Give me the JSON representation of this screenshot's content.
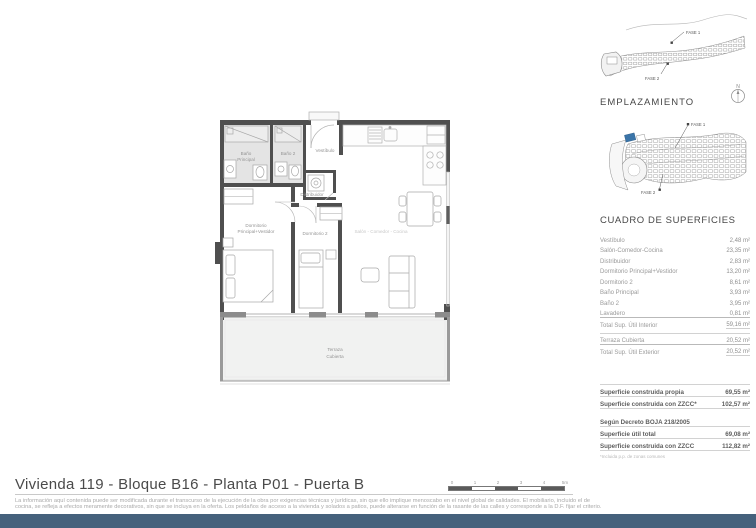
{
  "floorplan": {
    "labels": {
      "bano_principal_1": "Baño",
      "bano_principal_2": "Principal",
      "bano2": "Baño 2",
      "vestibulo": "Vestíbulo",
      "distribuidor": "Distribuidor",
      "dorm_ppal_1": "Dormitorio",
      "dorm_ppal_2": "Principal+Vestidor",
      "dorm2": "Dormitorio 2",
      "salon": "Salón - Comedor - Cocina",
      "terraza_1": "Terraza",
      "terraza_2": "Cubierta"
    }
  },
  "sidebar": {
    "aerial": {
      "fase1": "FASE 1",
      "fase2": "FASE 2"
    },
    "north_label": "N",
    "emplazamiento_title": "EMPLAZAMIENTO",
    "siteplan": {
      "fase1": "FASE 1",
      "fase2": "FASE 2"
    },
    "superficies": {
      "title": "CUADRO DE SUPERFICIES",
      "rows": [
        {
          "label": "Vestíbulo",
          "value": "2,48 m²"
        },
        {
          "label": "Salón-Comedor-Cocina",
          "value": "23,35 m²"
        },
        {
          "label": "Distribuidor",
          "value": "2,83 m²"
        },
        {
          "label": "Dormitorio Principal+Vestidor",
          "value": "13,20 m²"
        },
        {
          "label": "Dormitorio 2",
          "value": "8,61 m²"
        },
        {
          "label": "Baño Principal",
          "value": "3,93 m²"
        },
        {
          "label": "Baño 2",
          "value": "3,95 m²"
        },
        {
          "label": "Lavadero",
          "value": "0,81 m²"
        }
      ],
      "total_interior": {
        "label": "Total Sup. Útil Interior",
        "value": "59,16 m²"
      },
      "terraza": {
        "label": "Terraza Cubierta",
        "value": "20,52 m²"
      },
      "total_exterior": {
        "label": "Total Sup. Útil Exterior",
        "value": "20,52 m²"
      },
      "construida": [
        {
          "label": "Superficie construida propia",
          "value": "69,55 m²"
        },
        {
          "label": "Superficie construida con ZZCC*",
          "value": "102,57 m²"
        }
      ],
      "decreto_title": "Según Decreto BOJA 218/2005",
      "decreto_rows": [
        {
          "label": "Superficie útil total",
          "value": "69,08 m²"
        },
        {
          "label": "Superficie construida con ZZCC",
          "value": "112,82 m²"
        }
      ],
      "footnote": "*Incluida p.p. de zonas comunes"
    }
  },
  "footer": {
    "title": "Vivienda 119 - Bloque B16 - Planta P01 - Puerta B",
    "scale_labels": [
      "0",
      "1",
      "2",
      "3",
      "4",
      "5m"
    ],
    "disclaimer_line1": "La información aquí contenida puede ser modificada durante el transcurso de la ejecución de la obra por exigencias técnicas y jurídicas, sin que ello implique menoscabo en el nivel global de calidades. El mobiliario, incluido el de",
    "disclaimer_line2": "cocina, se refleja a efectos meramente decorativos, sin que se incluya en la oferta. Los peldaños de acceso a la vivienda y solados a patios, puede alterarse en función de la rasante de las calles y corresponde a la D.F. fijar el criterio."
  },
  "colors": {
    "wall": "#4f4f4f",
    "accent_blue": "#3a74a8",
    "bottom_bar": "#45617c",
    "bath_floor": "#e4e4e4",
    "terrace_floor": "#f1f2f1"
  }
}
